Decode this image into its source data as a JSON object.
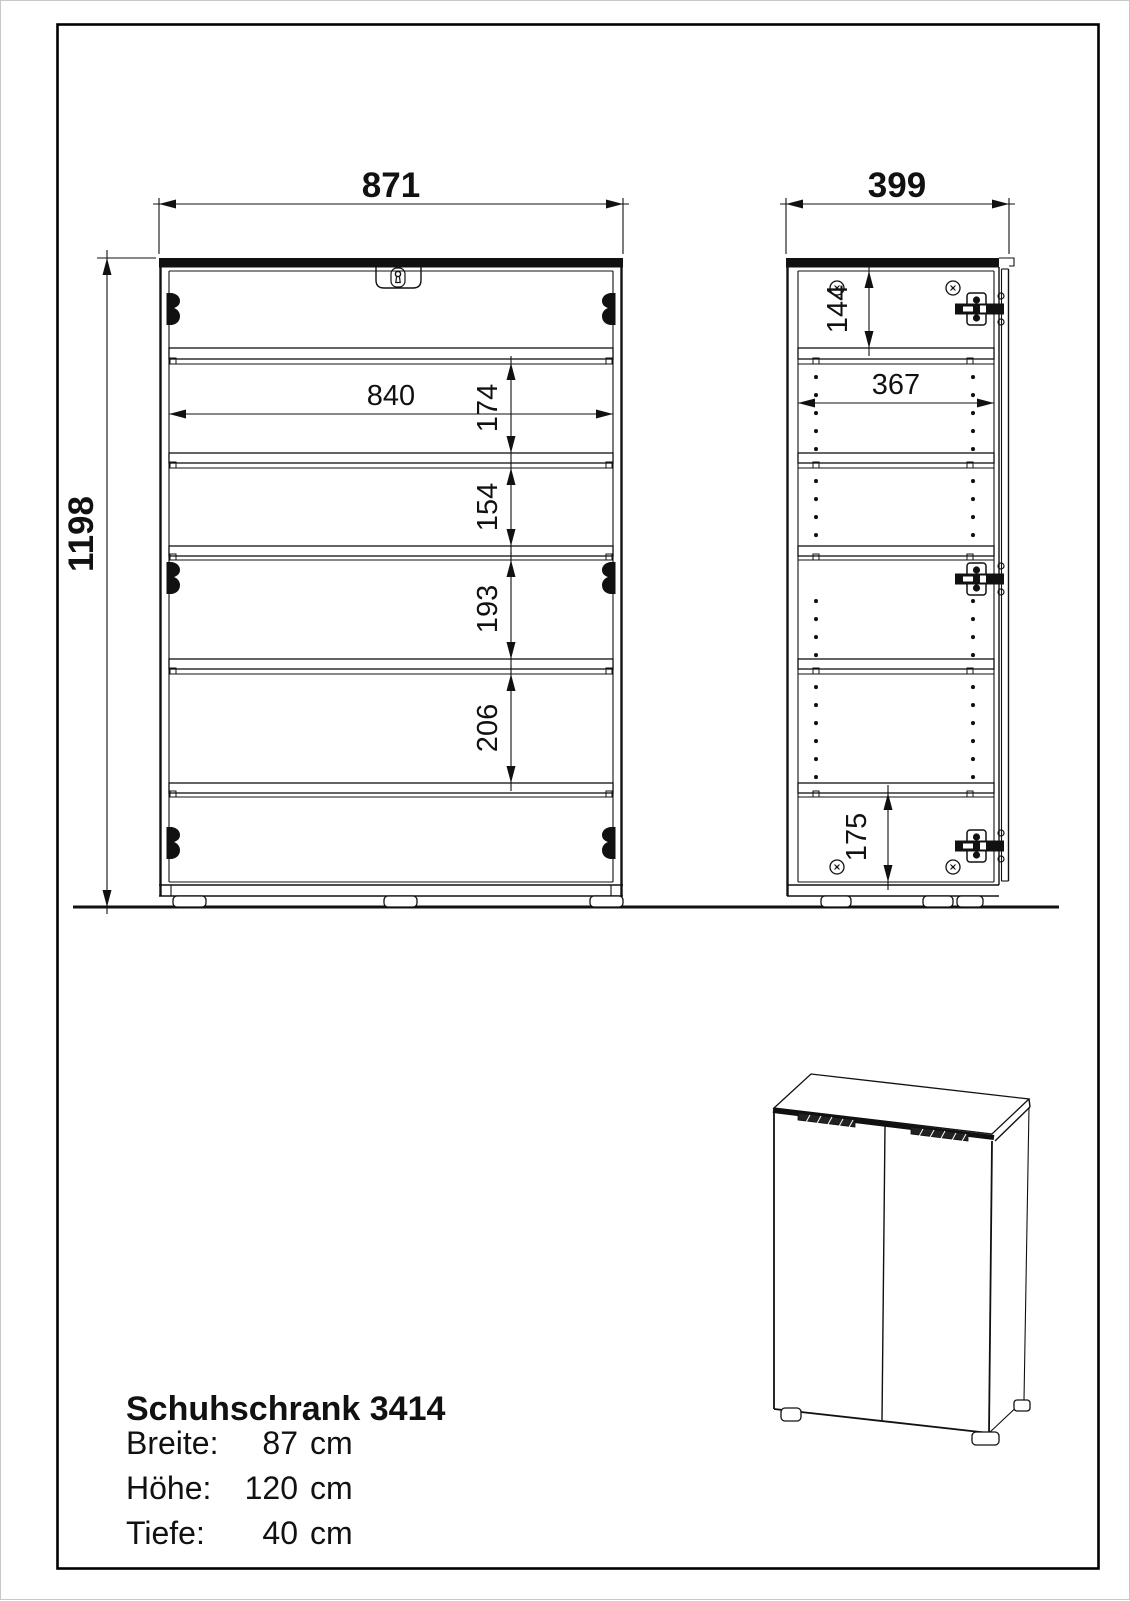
{
  "drawing": {
    "front_view": {
      "overall_width": "871",
      "overall_height": "1198",
      "inner_width": "840",
      "compartment_heights": [
        "174",
        "154",
        "193",
        "206"
      ]
    },
    "side_view": {
      "overall_depth": "399",
      "top_compartment": "144",
      "inner_depth": "367",
      "bottom_compartment": "175"
    }
  },
  "title_block": {
    "title": "Schuhschrank 3414",
    "specs": [
      {
        "label": "Breite:",
        "value": "87",
        "unit": "cm"
      },
      {
        "label": "Höhe:",
        "value": "120",
        "unit": "cm"
      },
      {
        "label": "Tiefe:",
        "value": "40",
        "unit": "cm"
      }
    ]
  }
}
